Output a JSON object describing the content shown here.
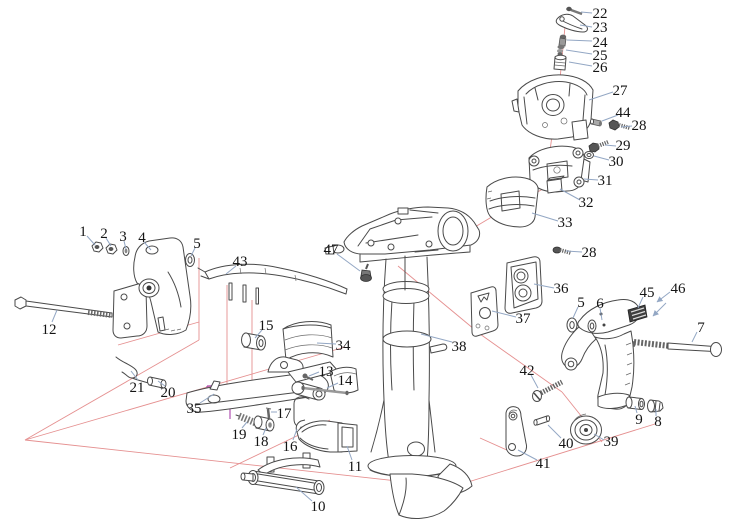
{
  "diagram": {
    "type": "exploded-parts-diagram",
    "title": "Outboard motor clamp and swivel bracket assembly - exploded view",
    "part_count_visible": 47
  },
  "colors": {
    "background": "#ffffff",
    "part_line": "#4a4a4a",
    "leader_line": "#93a7c4",
    "axis_line": "#e59090",
    "highlight_line": "#b050b0",
    "label_text": "#141414"
  },
  "callouts": [
    {
      "n": "1",
      "x": 83,
      "y": 231,
      "leader": [
        87,
        236,
        95,
        245
      ]
    },
    {
      "n": "2",
      "x": 104,
      "y": 233,
      "leader": [
        106,
        238,
        111,
        246
      ]
    },
    {
      "n": "3",
      "x": 123,
      "y": 236,
      "leader": [
        124,
        241,
        126,
        249
      ]
    },
    {
      "n": "4",
      "x": 142,
      "y": 237,
      "leader": [
        144,
        242,
        151,
        250
      ]
    },
    {
      "n": "5",
      "x": 197,
      "y": 243,
      "leader": [
        195,
        248,
        191,
        256
      ]
    },
    {
      "n": "12",
      "x": 49,
      "y": 329,
      "leader": [
        52,
        322,
        57,
        310
      ]
    },
    {
      "n": "21",
      "x": 137,
      "y": 387,
      "leader": [
        138,
        380,
        131,
        371
      ]
    },
    {
      "n": "20",
      "x": 168,
      "y": 392,
      "leader": [
        165,
        386,
        158,
        381
      ]
    },
    {
      "n": "35",
      "x": 194,
      "y": 408,
      "leader": [
        200,
        403,
        214,
        394
      ]
    },
    {
      "n": "19",
      "x": 239,
      "y": 434,
      "leader": [
        242,
        428,
        247,
        422
      ]
    },
    {
      "n": "18",
      "x": 261,
      "y": 441,
      "leader": [
        263,
        435,
        266,
        428
      ]
    },
    {
      "n": "17",
      "x": 284,
      "y": 413,
      "leader": [
        277,
        412,
        271,
        412
      ]
    },
    {
      "n": "16",
      "x": 290,
      "y": 446,
      "leader": [
        293,
        440,
        297,
        429
      ]
    },
    {
      "n": "13",
      "x": 326,
      "y": 371,
      "leader": [
        319,
        372,
        309,
        376
      ]
    },
    {
      "n": "14",
      "x": 345,
      "y": 380,
      "leader": [
        338,
        383,
        327,
        388
      ]
    },
    {
      "n": "15",
      "x": 266,
      "y": 325,
      "leader": [
        262,
        330,
        255,
        338
      ]
    },
    {
      "n": "43",
      "x": 240,
      "y": 261,
      "leader": [
        236,
        266,
        226,
        274
      ]
    },
    {
      "n": "34",
      "x": 343,
      "y": 345,
      "leader": [
        336,
        344,
        317,
        343
      ]
    },
    {
      "n": "47",
      "x": 331,
      "y": 249,
      "leader": [
        337,
        254,
        360,
        271
      ]
    },
    {
      "n": "38",
      "x": 459,
      "y": 346,
      "leader": [
        452,
        342,
        421,
        334
      ]
    },
    {
      "n": "11",
      "x": 355,
      "y": 466,
      "leader": [
        352,
        460,
        347,
        446
      ]
    },
    {
      "n": "10",
      "x": 318,
      "y": 506,
      "leader": [
        312,
        501,
        296,
        487
      ]
    },
    {
      "n": "22",
      "x": 600,
      "y": 13,
      "leader": [
        592,
        13,
        581,
        12
      ]
    },
    {
      "n": "23",
      "x": 600,
      "y": 27,
      "leader": [
        592,
        27,
        580,
        25
      ]
    },
    {
      "n": "24",
      "x": 600,
      "y": 42,
      "leader": [
        592,
        41,
        567,
        40
      ]
    },
    {
      "n": "25",
      "x": 600,
      "y": 55,
      "leader": [
        592,
        54,
        566,
        50
      ]
    },
    {
      "n": "26",
      "x": 600,
      "y": 67,
      "leader": [
        592,
        66,
        569,
        62
      ]
    },
    {
      "n": "27",
      "x": 620,
      "y": 90,
      "leader": [
        613,
        92,
        589,
        100
      ]
    },
    {
      "n": "44",
      "x": 623,
      "y": 112,
      "leader": [
        618,
        115,
        602,
        121
      ]
    },
    {
      "n": "28",
      "x": 639,
      "y": 125,
      "leader": [
        632,
        126,
        621,
        127
      ]
    },
    {
      "n": "29",
      "x": 623,
      "y": 145,
      "leader": [
        616,
        146,
        605,
        145
      ]
    },
    {
      "n": "30",
      "x": 616,
      "y": 161,
      "leader": [
        609,
        160,
        594,
        156
      ]
    },
    {
      "n": "31",
      "x": 605,
      "y": 180,
      "leader": [
        598,
        180,
        584,
        179
      ]
    },
    {
      "n": "32",
      "x": 586,
      "y": 202,
      "leader": [
        580,
        200,
        560,
        189
      ]
    },
    {
      "n": "33",
      "x": 565,
      "y": 222,
      "leader": [
        558,
        221,
        532,
        213
      ]
    },
    {
      "n": "28",
      "x": 589,
      "y": 252,
      "leader": [
        582,
        252,
        566,
        251
      ]
    },
    {
      "n": "36",
      "x": 561,
      "y": 288,
      "leader": [
        554,
        288,
        534,
        284
      ]
    },
    {
      "n": "37",
      "x": 523,
      "y": 318,
      "leader": [
        516,
        317,
        492,
        311
      ]
    },
    {
      "n": "5",
      "x": 581,
      "y": 302,
      "leader": [
        578,
        307,
        573,
        318
      ]
    },
    {
      "n": "6",
      "x": 600,
      "y": 303,
      "leader": [
        600,
        308,
        602,
        320
      ]
    },
    {
      "n": "45",
      "x": 647,
      "y": 292,
      "leader": [
        643,
        297,
        638,
        308
      ]
    },
    {
      "n": "46",
      "x": 678,
      "y": 288,
      "leader": null
    },
    {
      "n": "7",
      "x": 701,
      "y": 327,
      "leader": [
        697,
        332,
        692,
        342
      ]
    },
    {
      "n": "9",
      "x": 639,
      "y": 419,
      "leader": [
        637,
        413,
        635,
        406
      ]
    },
    {
      "n": "8",
      "x": 658,
      "y": 421,
      "leader": [
        656,
        416,
        656,
        409
      ]
    },
    {
      "n": "42",
      "x": 527,
      "y": 370,
      "leader": [
        531,
        375,
        538,
        388
      ]
    },
    {
      "n": "40",
      "x": 566,
      "y": 443,
      "leader": [
        561,
        438,
        548,
        425
      ]
    },
    {
      "n": "39",
      "x": 611,
      "y": 441,
      "leader": [
        604,
        440,
        594,
        434
      ]
    },
    {
      "n": "41",
      "x": 543,
      "y": 463,
      "leader": [
        537,
        460,
        518,
        450
      ]
    }
  ],
  "arrow_leaders": [
    [
      670,
      292,
      657,
      302
    ],
    [
      666,
      303,
      653,
      316
    ]
  ],
  "axis_lines": [
    [
      566,
      16,
      558,
      100
    ],
    [
      556,
      106,
      549,
      158
    ],
    [
      549,
      160,
      553,
      188
    ],
    [
      563,
      178,
      490,
      218
    ],
    [
      490,
      218,
      443,
      246
    ],
    [
      398,
      266,
      480,
      334
    ],
    [
      480,
      334,
      562,
      392
    ],
    [
      562,
      392,
      602,
      442
    ],
    [
      25,
      440,
      345,
      347
    ],
    [
      25,
      440,
      452,
      487
    ],
    [
      452,
      487,
      655,
      424
    ],
    [
      199,
      258,
      199,
      340
    ],
    [
      199,
      340,
      25,
      440
    ],
    [
      199,
      322,
      118,
      345
    ],
    [
      227,
      285,
      227,
      385
    ],
    [
      252,
      300,
      252,
      382
    ],
    [
      480,
      438,
      520,
      456
    ],
    [
      230,
      468,
      330,
      420
    ]
  ],
  "highlight_lines": [
    [
      207,
      398,
      207,
      386
    ],
    [
      207,
      386,
      240,
      385
    ],
    [
      265,
      381,
      287,
      381
    ],
    [
      287,
      381,
      287,
      394
    ],
    [
      230,
      386,
      230,
      419
    ]
  ]
}
